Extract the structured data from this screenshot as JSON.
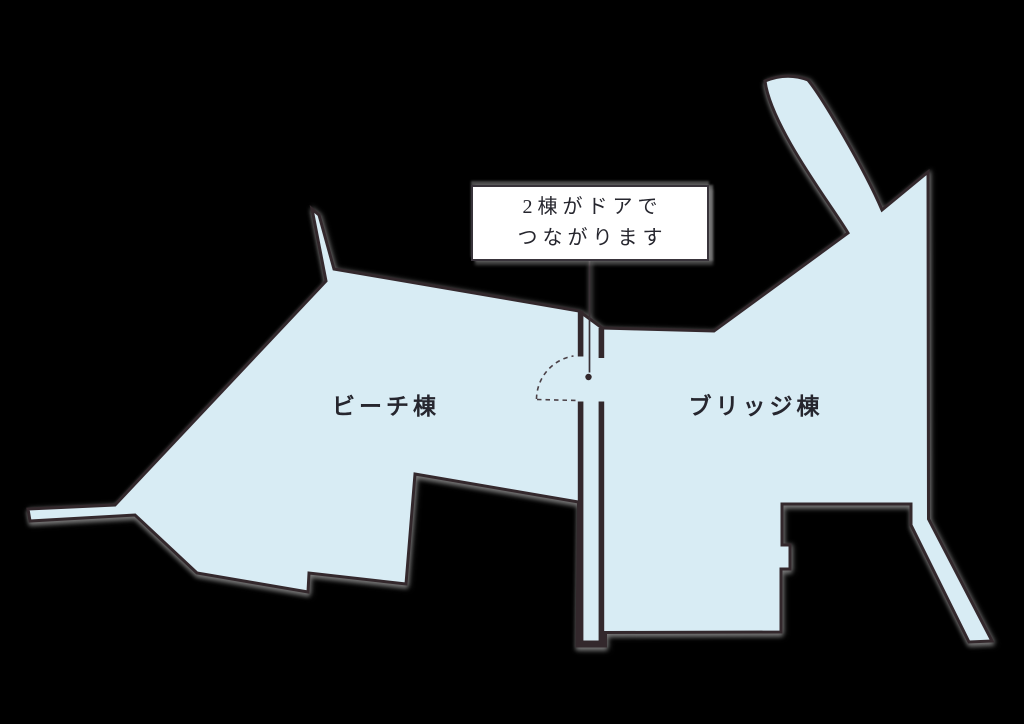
{
  "figure": {
    "callout": {
      "line1": "2棟がドアで",
      "line2": "つながります"
    },
    "buildings": [
      {
        "id": "beach",
        "label": "ビーチ棟"
      },
      {
        "id": "bridge",
        "label": "ブリッジ棟"
      }
    ],
    "icons": {
      "door": "door-swing-arc",
      "pointer": "callout-pointer-dot"
    },
    "colors": {
      "background": "#000000",
      "building_fill": "#d8ecf4",
      "outline": "#33282c",
      "callout_bg": "#ffffff",
      "callout_border": "#38333a",
      "text": "#26262e",
      "shadow": "#969696"
    }
  }
}
